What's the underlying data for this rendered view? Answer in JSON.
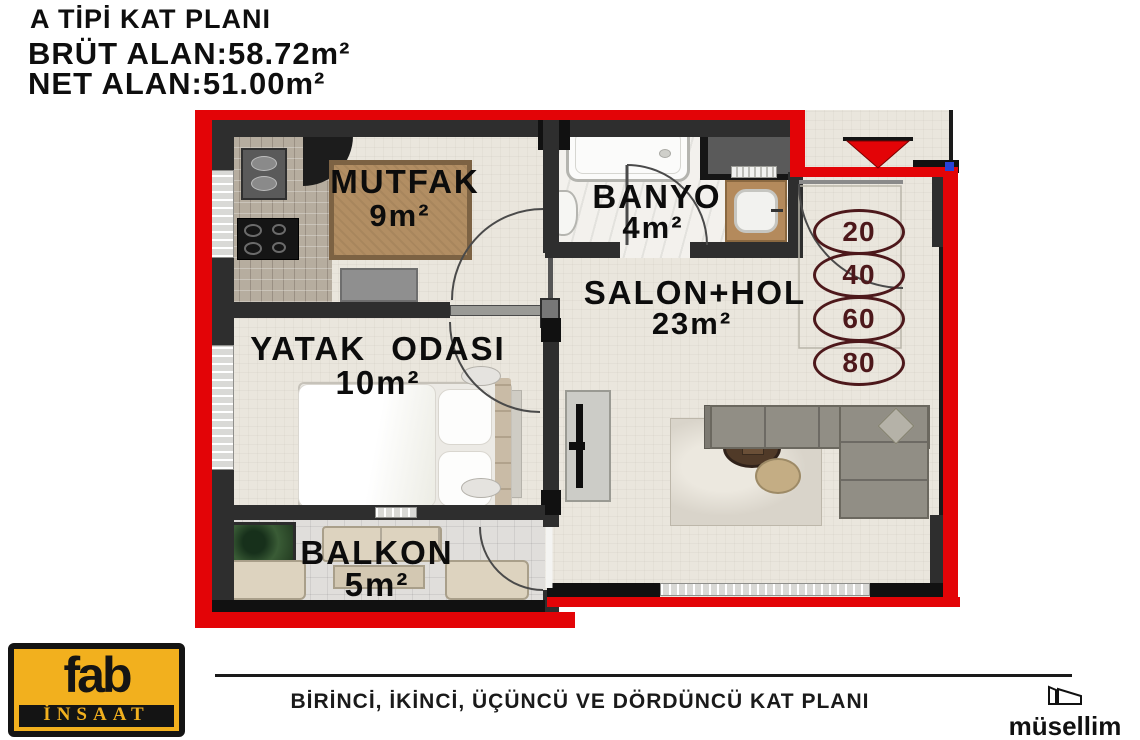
{
  "header": {
    "title": "A TİPİ KAT PLANI",
    "gross_area": "BRÜT ALAN:58.72m²",
    "net_area": "NET ALAN:51.00m²"
  },
  "plan": {
    "rooms": {
      "kitchen": {
        "name": "MUTFAK",
        "area": "9m²"
      },
      "bathroom": {
        "name": "BANYO",
        "area": "4m²"
      },
      "living": {
        "name": "SALON+HOL",
        "area": "23m²"
      },
      "bedroom": {
        "name": "YATAK ODASI",
        "area": "10m²"
      },
      "balcony": {
        "name": "BALKON",
        "area": "5m²"
      }
    },
    "measure_badges": [
      "20",
      "40",
      "60",
      "80"
    ],
    "colors": {
      "outer_wall_red": "#e30407",
      "inner_wall_dark": "#2e2e2e",
      "badge_maroon": "#4d181b",
      "floor_beige": "#eae6dd"
    }
  },
  "footer": {
    "logo_top": "fab",
    "logo_bottom": "İNSAAT",
    "caption": "BİRİNCİ, İKİNCİ, ÜÇÜNCÜ VE DÖRDÜNCÜ KAT PLANI",
    "brand": "müsellim",
    "logo_colors": {
      "yellow": "#f2b01e",
      "black": "#141414"
    }
  }
}
